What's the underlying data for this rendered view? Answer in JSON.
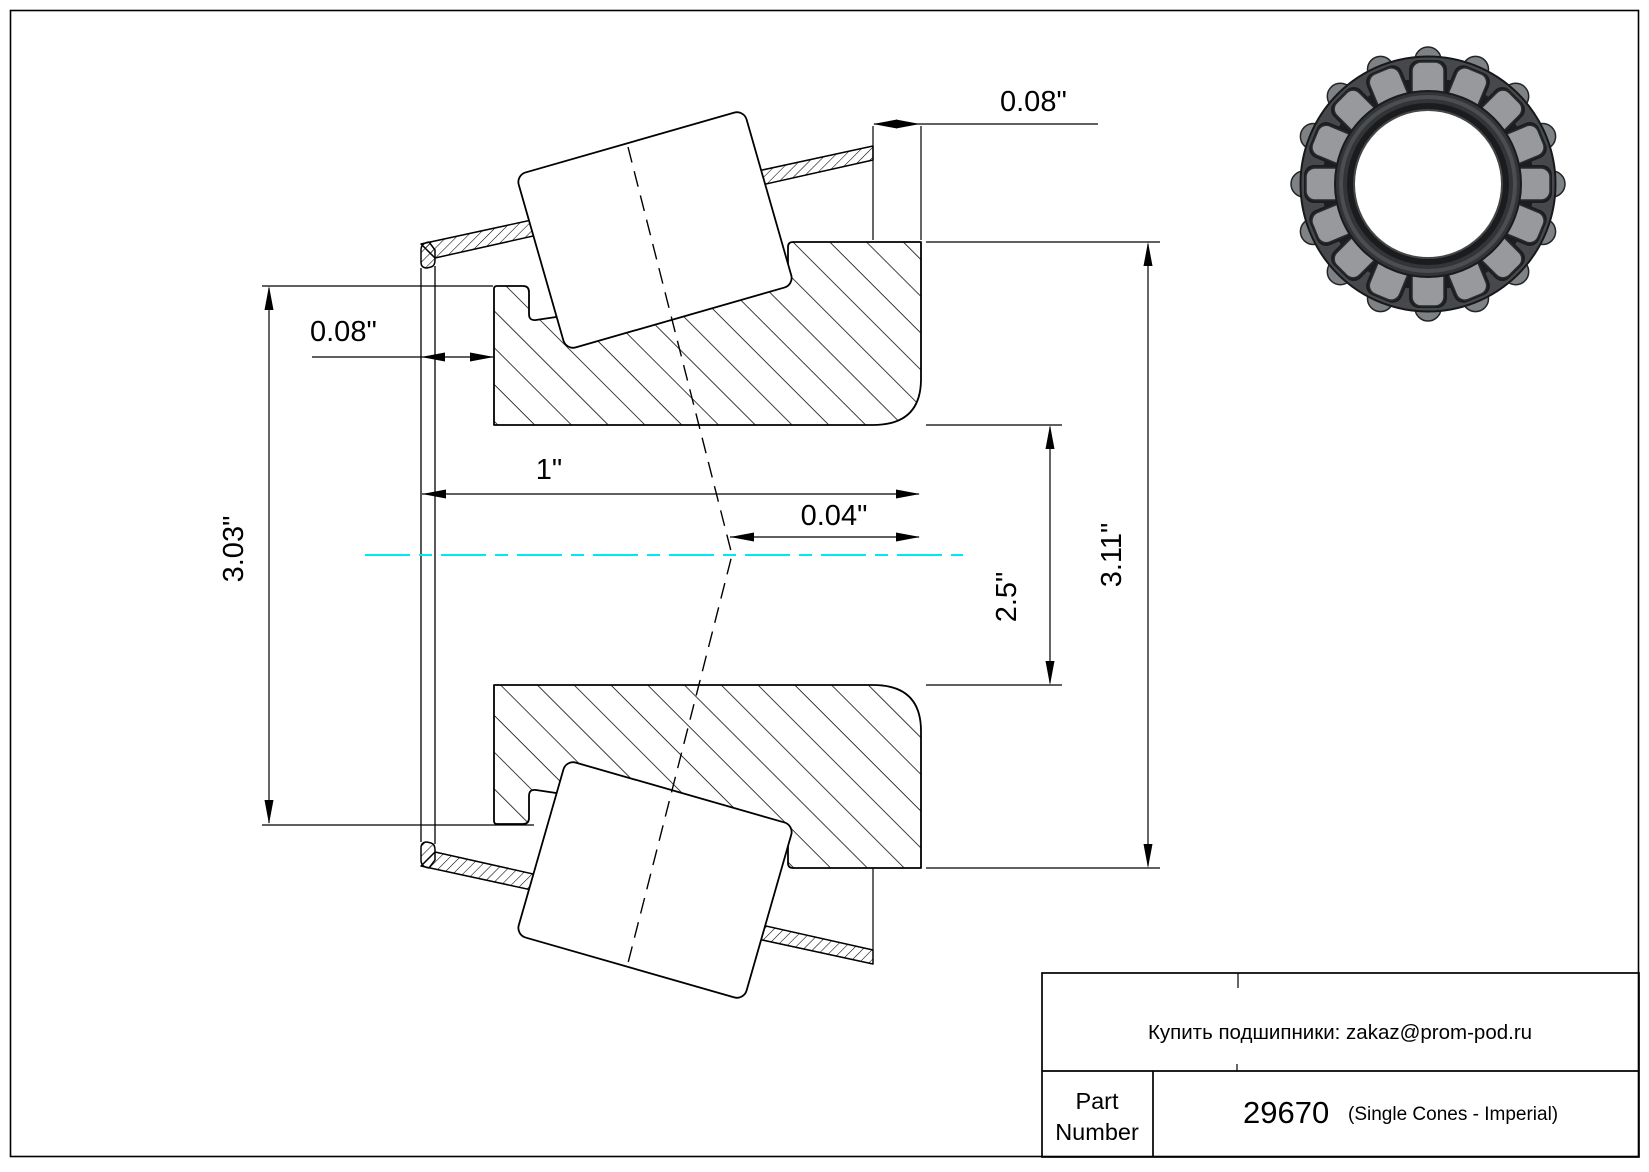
{
  "drawing": {
    "dims": {
      "rib_gap": "0.08\"",
      "back_gap": "0.08\"",
      "width": "1\"",
      "load_center": "0.04\"",
      "bore": "2.5\"",
      "rib_od": "3.03\"",
      "backing_od": "3.11\""
    },
    "centerline_color": "#00e8f0"
  },
  "title_block": {
    "note": "Купить подшипники: zakaz@prom-pod.ru",
    "part_label_line1": "Part",
    "part_label_line2": "Number",
    "part_number": "29670",
    "part_series": "(Single Cones - Imperial)"
  },
  "images": {
    "bearing_render": "tapered-roller-bearing-3d-view"
  }
}
